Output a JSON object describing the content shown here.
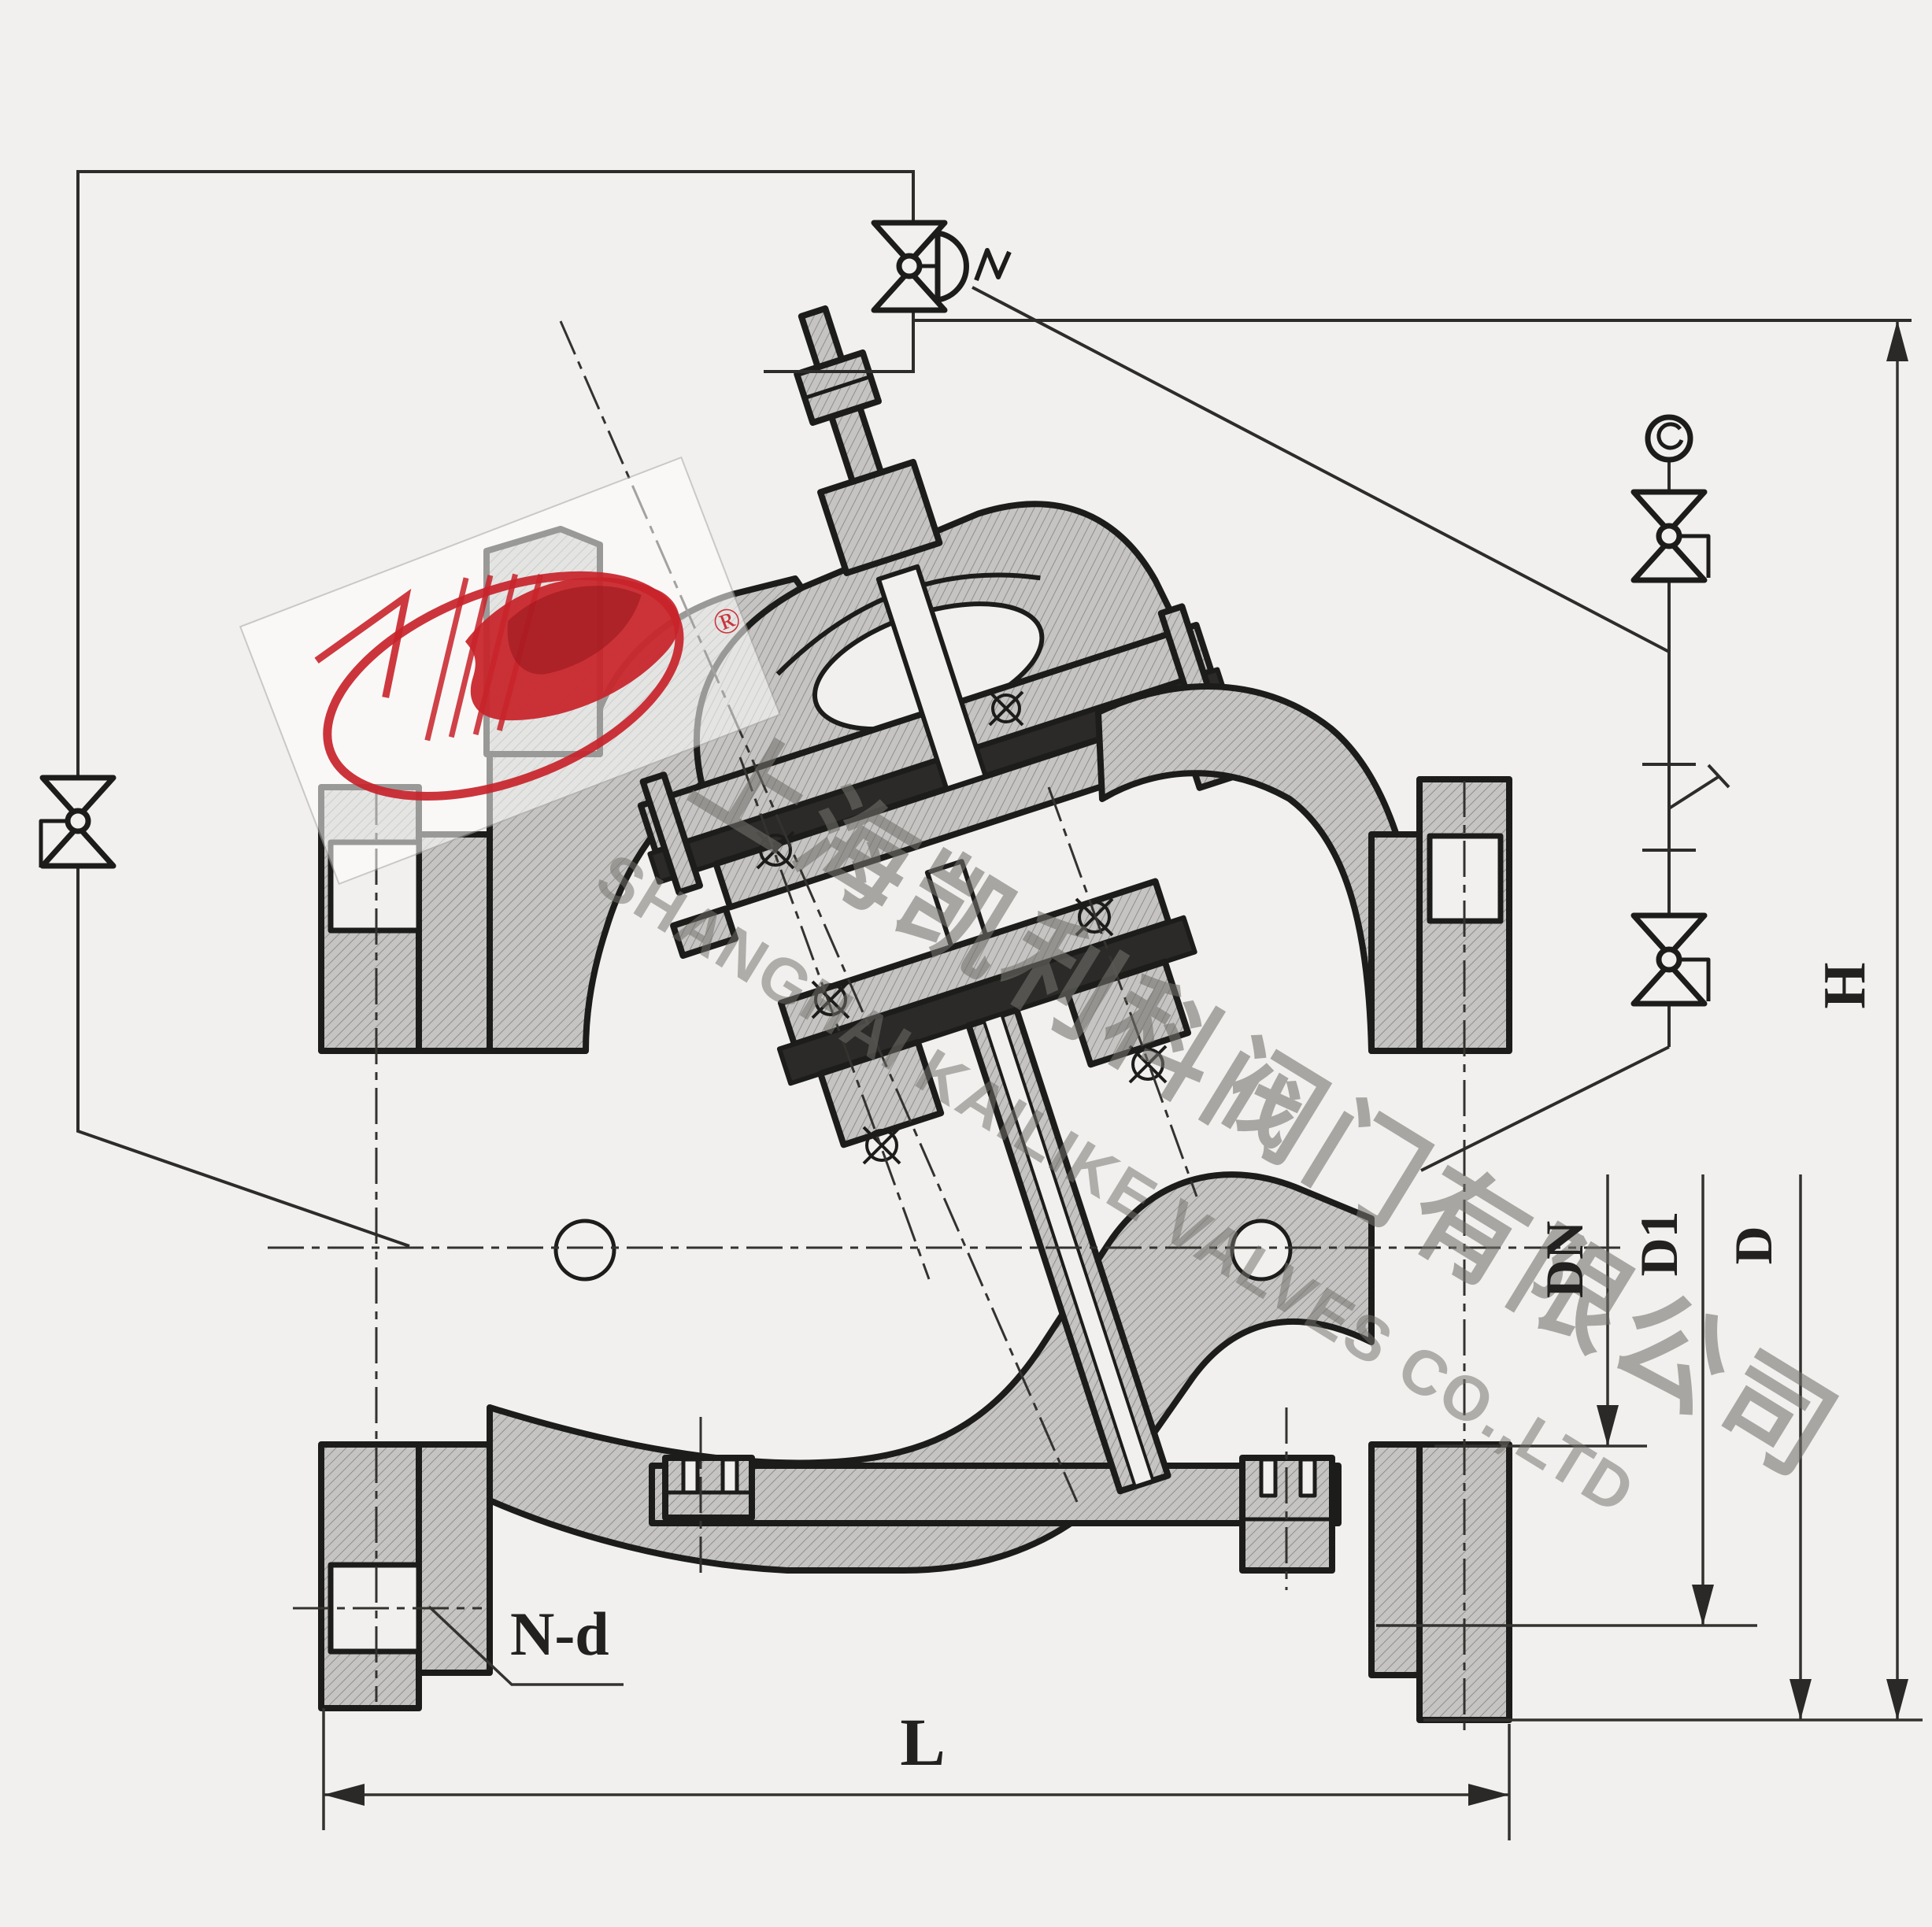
{
  "drawing": {
    "type": "valve-cross-section-engineering-drawing",
    "subject": "diaphragm multifunctional pump control valve with pilot piping",
    "watermark": {
      "company_cn": "上海凯利科阀门有限公司",
      "company_en": "SHANGHAI KAILIKE VALVES CO.,LTD",
      "registered_mark": "®"
    },
    "dimension_labels": {
      "length": "L",
      "height": "H",
      "flange_outer_diameter": "D",
      "bolt_circle_diameter": "D1",
      "nominal_diameter": "DN",
      "bolt_holes": "N-d"
    },
    "pilot_circuit_icons": [
      "needle-valve-icon-top",
      "diaphragm-actuator-icon",
      "needle-valve-icon-left",
      "pressure-gauge-icon",
      "needle-valve-icon-right-upper",
      "strainer-tap-icon",
      "needle-valve-icon-right-lower"
    ],
    "colors": {
      "paper": "#f2f0ee",
      "outline": "#1c1c1a",
      "thin_line": "#34322f",
      "section_fill": "#c5c4c2",
      "hatch_line": "#8f8e8c",
      "rubber_dark": "#2b2a28",
      "logo_red": "#c8232a",
      "watermark_gray": "#72716d"
    }
  }
}
